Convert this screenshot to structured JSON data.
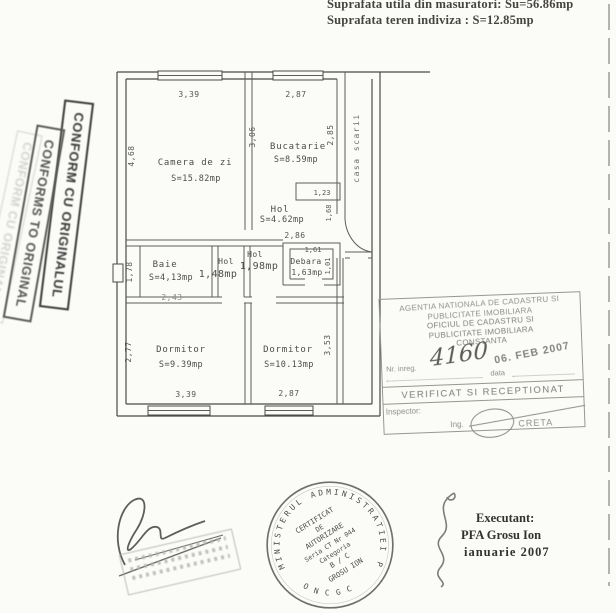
{
  "header": {
    "line1": "Suprafata utila din masuratori: Su=56.86mp",
    "line2": "Suprafata teren indiviza : S=12.85mp"
  },
  "left_stamps": {
    "romanian": "CONFORM CU ORIGINALUL",
    "english": "CONFORMS TO ORIGINAL"
  },
  "floor_plan": {
    "stairwell": "casa scarii",
    "rooms": [
      {
        "name": "Camera de zi",
        "area": "S=15.82mp"
      },
      {
        "name": "Bucatarie",
        "area": "S=8.59mp"
      },
      {
        "name": "Hol",
        "area": "S=4.62mp"
      },
      {
        "name": "Baie",
        "area": "S=4,13mp"
      },
      {
        "name": "Hol",
        "area": "1,48mp"
      },
      {
        "name": "Hol",
        "area": "1,98mp"
      },
      {
        "name": "Debara",
        "area": "1,63mp"
      },
      {
        "name": "Dormitor",
        "area": "S=9.39mp"
      },
      {
        "name": "Dormitor",
        "area": "S=10.13mp"
      }
    ],
    "dimensions": {
      "camera_width": "3,39",
      "camera_height": "4,68",
      "bucatarie_width": "2,87",
      "bucatarie_height": "2,85",
      "wall_height": "3,06",
      "hol_notch": "1,23",
      "hol_height": "1,68",
      "hol_width": "2,86",
      "baie_height": "1,78",
      "baie_width": "2,43",
      "debara_width": "1,61",
      "debara_height": "1,01",
      "dormitor1_height": "2,77",
      "dormitor1_width": "3,39",
      "dormitor2_width": "2,87",
      "dormitor2_height": "3,53"
    }
  },
  "ocpi_stamp": {
    "agency_line1": "AGENTIA NATIONALA DE CADASTRU SI",
    "agency_line2": "PUBLICITATE IMOBILIARA",
    "office_line1": "OFICIUL DE CADASTRU SI",
    "office_line2": "PUBLICITATE IMOBILIARA",
    "office_city": "CONSTANTA",
    "reg_label": "Nr. inreg.",
    "reg_number": "4160",
    "date_label": "data",
    "date_stamp": "06. FEB 2007",
    "verified": "VERIFICAT SI RECEPTIONAT",
    "inspector_label": "Inspector:",
    "inspector_title": "Ing.",
    "inspector_name": "CRETA"
  },
  "round_stamp": {
    "ring_text": "MINISTERUL ADMINISTRATIEI PUBLICE",
    "ring_bottom": "ONCGC",
    "line1": "CERTIFICAT",
    "line2": "DE",
    "line3": "AUTORIZARE",
    "line4": "Seria CT Nr 044",
    "line5": "Categoria",
    "line6": "B / C",
    "line7": "GROSU ION"
  },
  "executant": {
    "label": "Executant:",
    "name": "PFA Grosu Ion",
    "date": "ianuarie 2007"
  }
}
